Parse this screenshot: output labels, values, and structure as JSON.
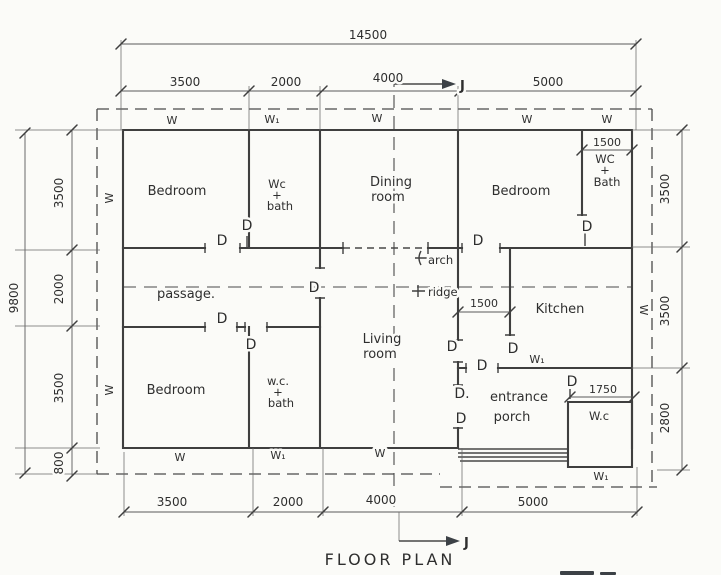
{
  "title": "FLOOR PLAN",
  "section_label": "J",
  "door_label": "D",
  "window_label": "W",
  "window1_label": "W₁",
  "dimensions": {
    "overall_width": "14500",
    "overall_height": "9800",
    "top": [
      "3500",
      "2000",
      "4000",
      "5000"
    ],
    "bottom": [
      "3500",
      "2000",
      "4000",
      "5000"
    ],
    "left": [
      "3500",
      "2000",
      "3500",
      "800"
    ],
    "right": [
      "3500",
      "3500",
      "2800"
    ],
    "wc_bath_right_width": "1500",
    "kitchen_entry_width": "1500",
    "wc_rear_width": "1750"
  },
  "rooms": {
    "bedroom_top_left": "Bedroom",
    "wc_bath_top": [
      "Wc",
      "+",
      "bath"
    ],
    "dining": [
      "Dining",
      "room"
    ],
    "bedroom_top_right": "Bedroom",
    "wc_bath_right": [
      "WC",
      "+",
      "Bath"
    ],
    "passage": "passage.",
    "kitchen": "Kitchen",
    "living": [
      "Living",
      "room"
    ],
    "bedroom_bottom_left": "Bedroom",
    "wc_bath_bottom": [
      "w.c.",
      "+",
      "bath"
    ],
    "entrance_porch": [
      "entrance",
      "porch"
    ],
    "wc_rear": "W.c"
  },
  "annotations": {
    "arch": "arch",
    "ridge": "ridge",
    "door_dot": "D."
  }
}
